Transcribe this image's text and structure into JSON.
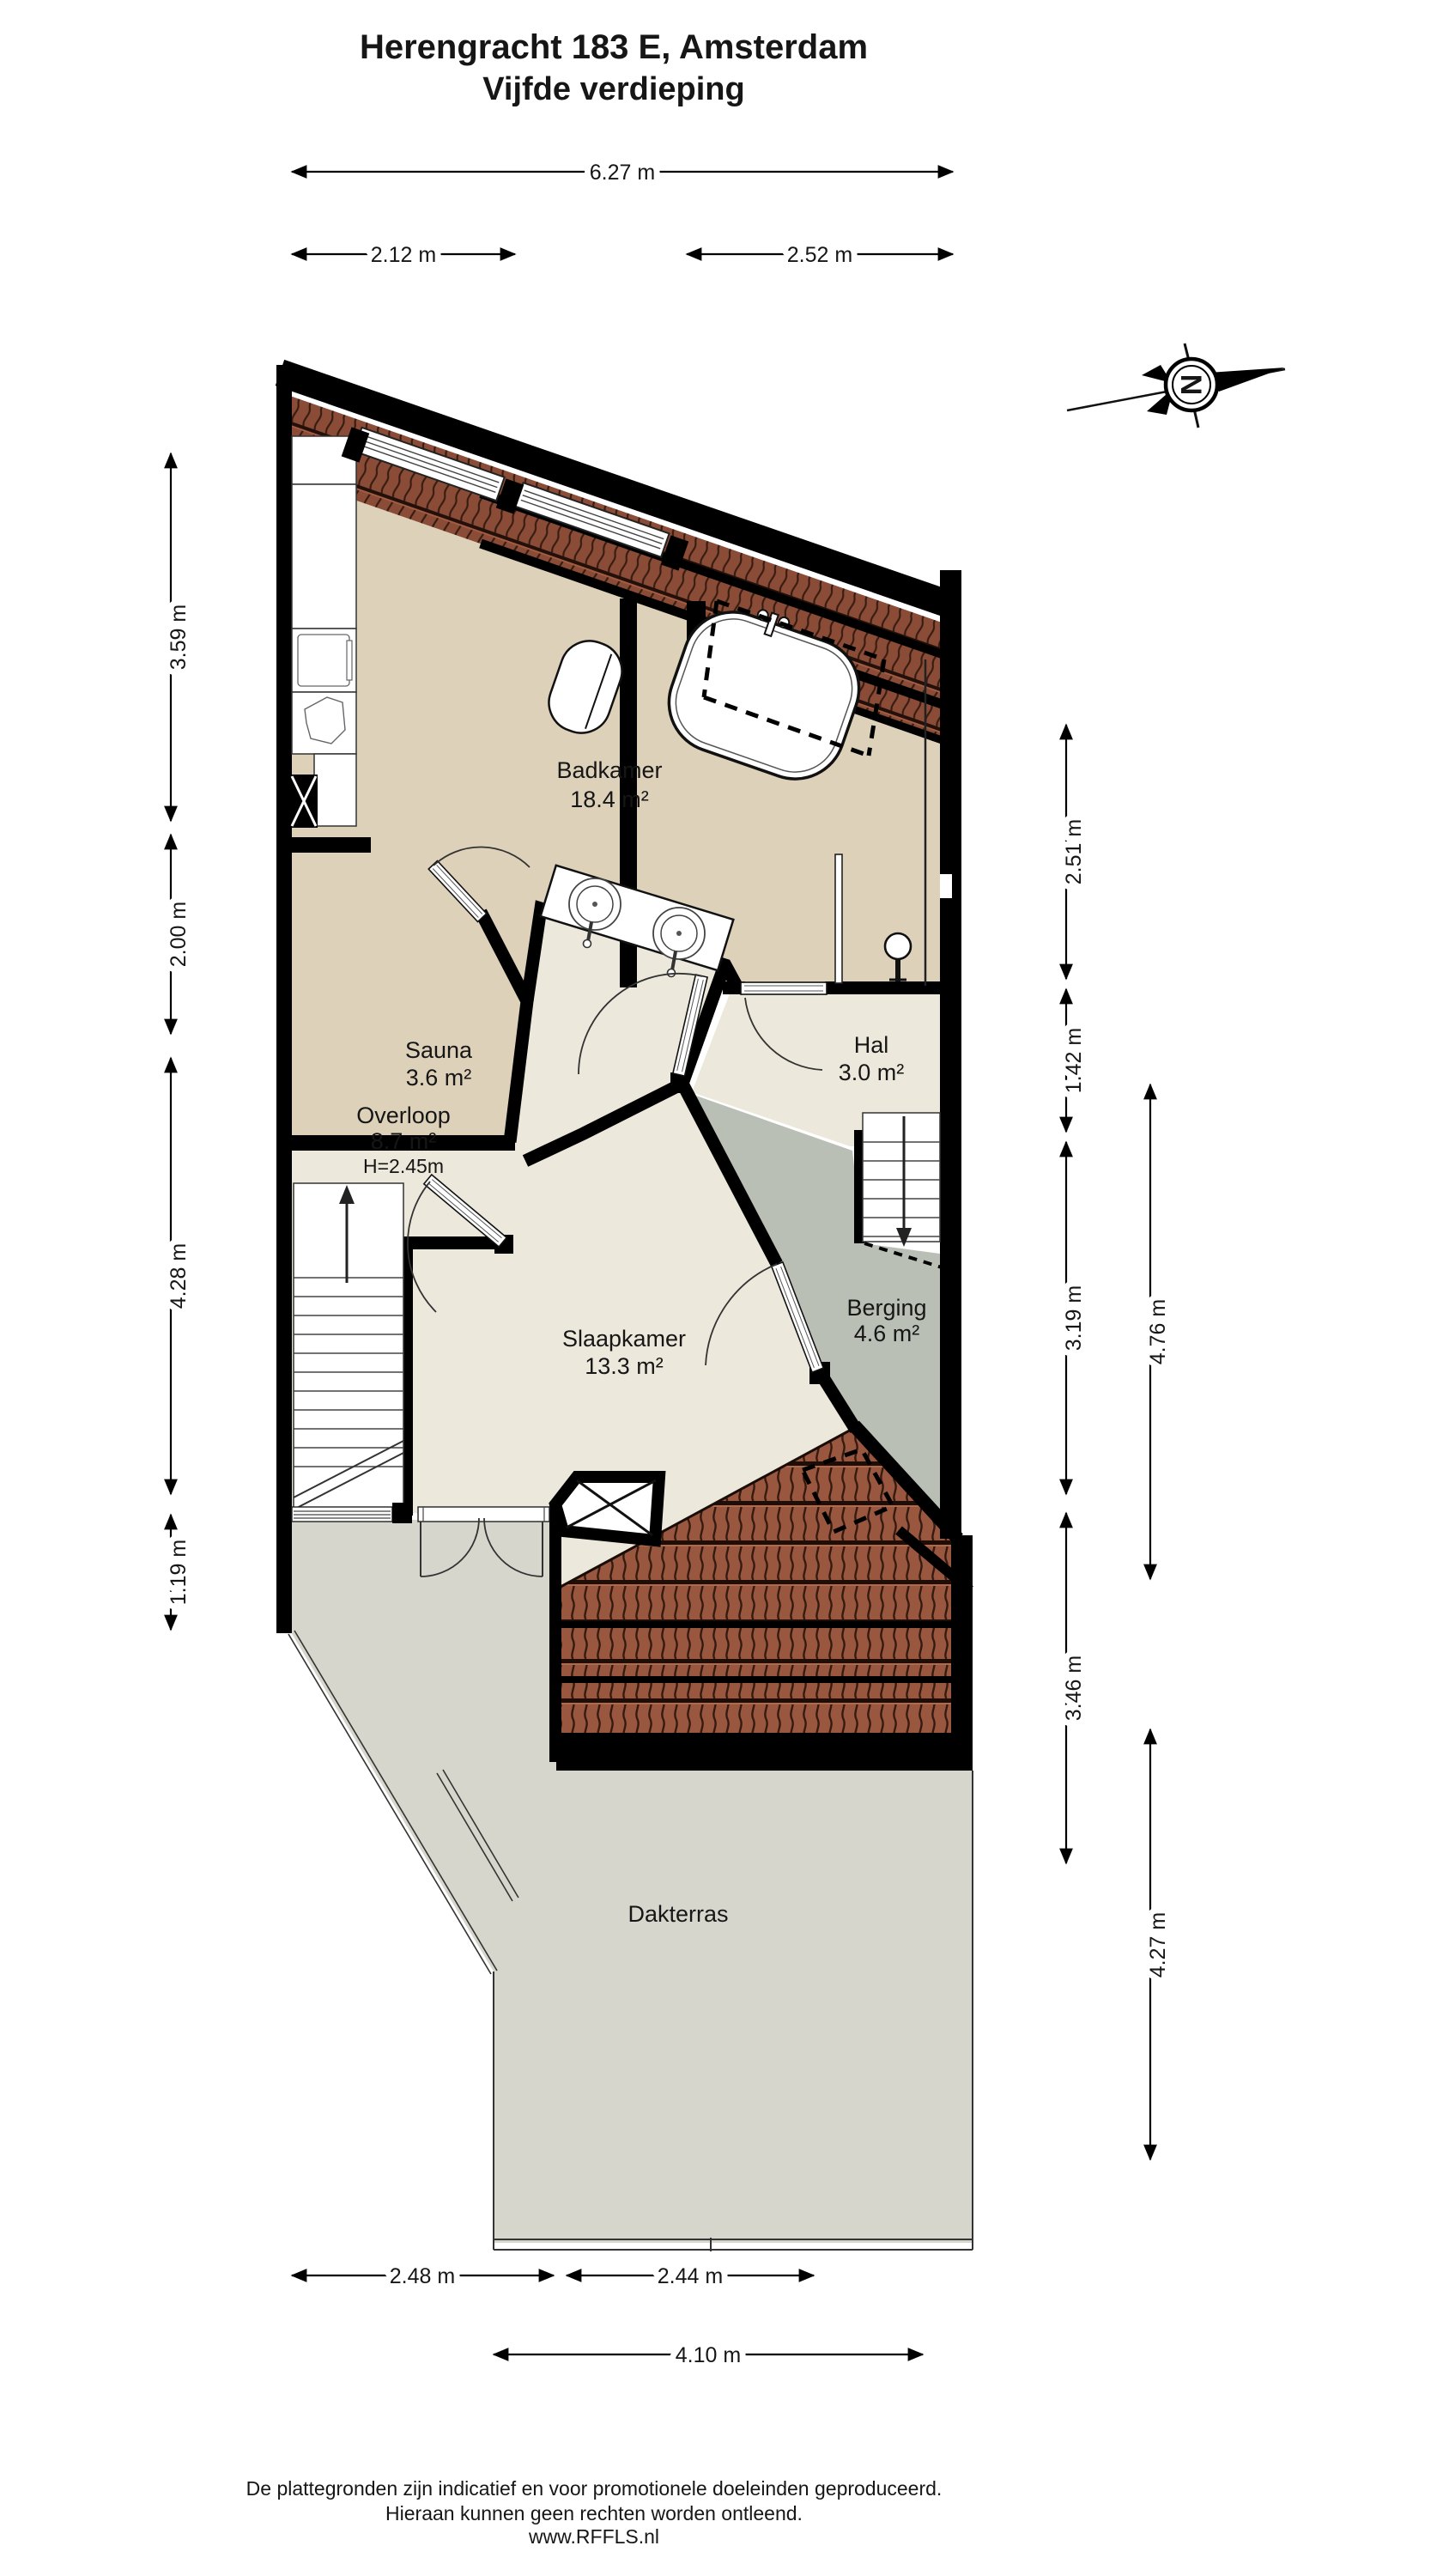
{
  "title": {
    "line1": "Herengracht 183 E, Amsterdam",
    "line2": "Vijfde verdieping"
  },
  "compass": {
    "letter": "N"
  },
  "rooms": {
    "badkamer": {
      "name": "Badkamer",
      "area": "18.4 m²"
    },
    "sauna": {
      "name": "Sauna",
      "area": "3.6 m²"
    },
    "hal": {
      "name": "Hal",
      "area": "3.0 m²"
    },
    "overloop": {
      "name": "Overloop",
      "area": "8.7 m²",
      "height": "H=2.45m"
    },
    "slaapkamer": {
      "name": "Slaapkamer",
      "area": "13.3 m²"
    },
    "berging": {
      "name": "Berging",
      "area": "4.6 m²"
    },
    "dakterras": {
      "name": "Dakterras"
    }
  },
  "dimensions": {
    "top_total": "6.27 m",
    "top_left": "2.12 m",
    "top_right": "2.52 m",
    "left": [
      "3.59 m",
      "2.00 m",
      "4.28 m",
      "1.19 m"
    ],
    "right_inner": [
      "2.51 m",
      "1.42 m",
      "3.19 m",
      "3.46 m"
    ],
    "right_outer": [
      "4.76 m",
      "4.27 m"
    ],
    "bottom_left": "2.48 m",
    "bottom_right": "2.44 m",
    "bottom_total": "4.10 m"
  },
  "footer": {
    "line1": "De plattegronden zijn indicatief en voor promotionele doeleinden geproduceerd.",
    "line2": "Hieraan kunnen geen rechten worden ontleend.",
    "line3": "www.RFFLS.nl"
  },
  "colors": {
    "wall": "#000000",
    "floor_bath": "#ddd1ba",
    "floor_living": "#ece8db",
    "floor_storage": "#b9bfb4",
    "floor_terrace": "#d7d6cd",
    "roof_tile_dark": "#8a4c37",
    "roof_tile_light": "#9a5740"
  }
}
